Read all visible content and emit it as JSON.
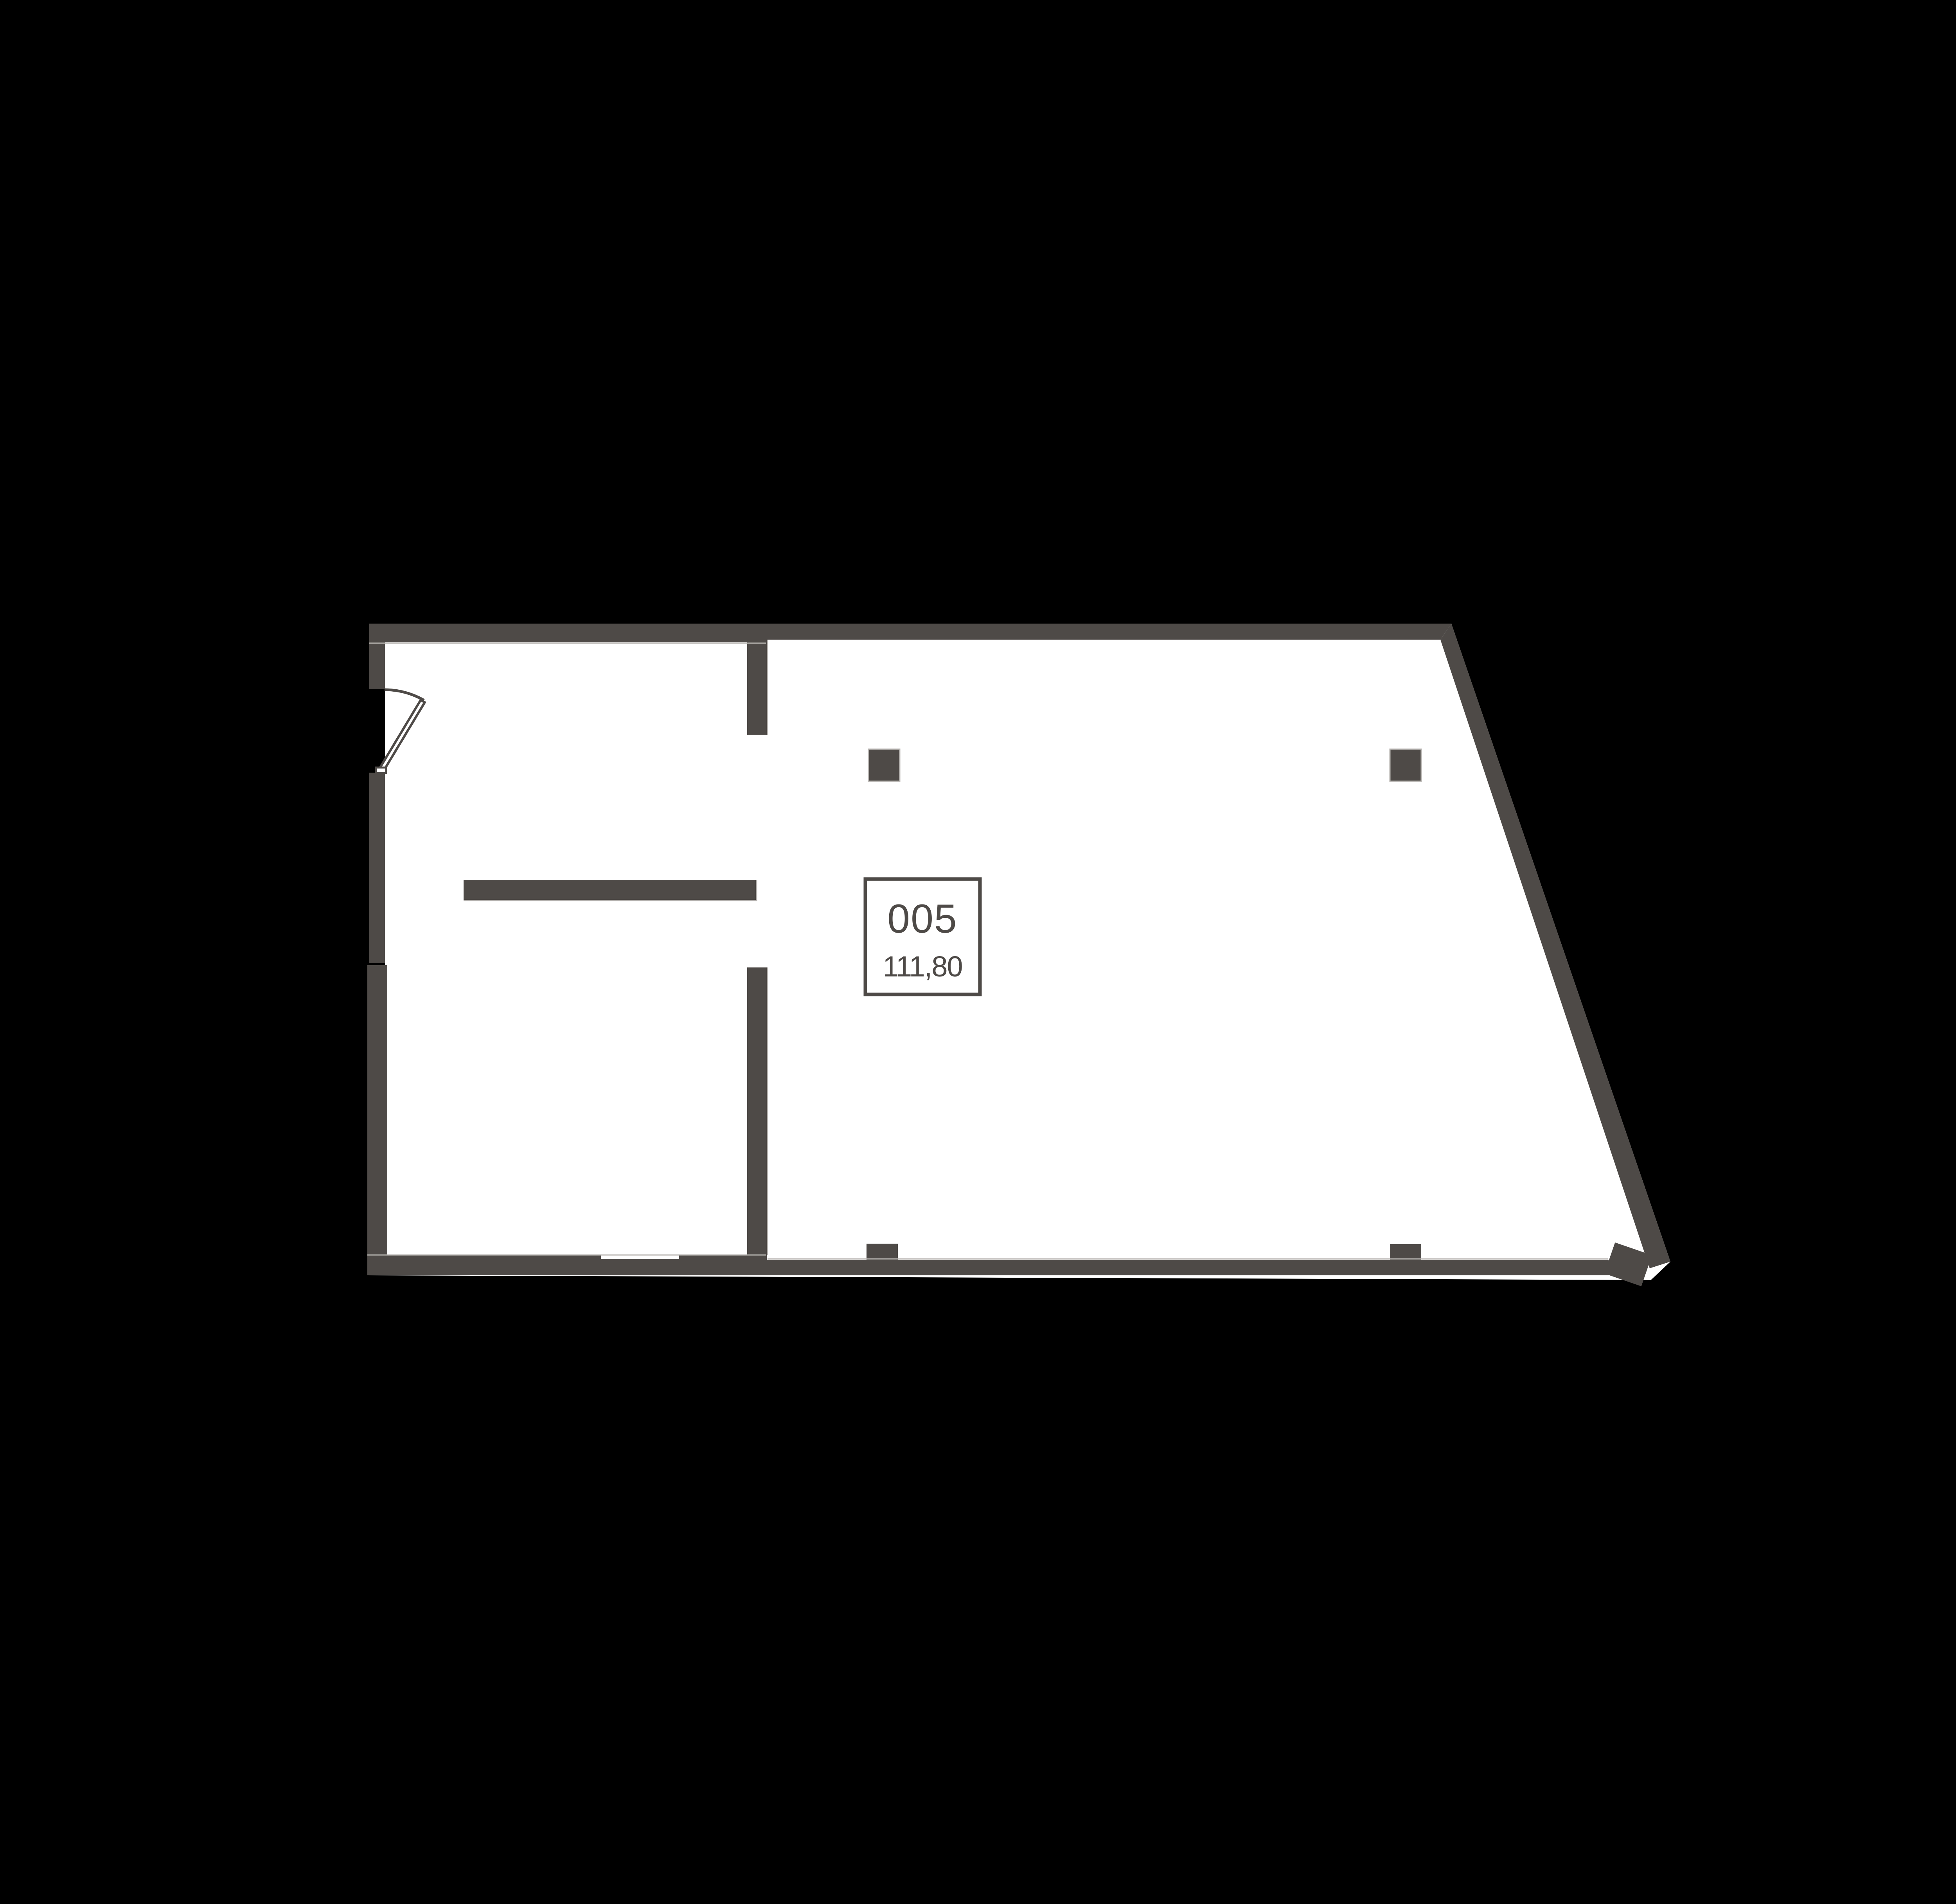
{
  "floor_plan": {
    "room": {
      "number": "005",
      "area": "111,80"
    },
    "colors": {
      "background": "#000000",
      "floor": "#ffffff",
      "wall": "#4e4a47",
      "edge_highlight": "#b8b5b2",
      "label_border": "#4e4a47",
      "label_text": "#4e4a47"
    }
  }
}
